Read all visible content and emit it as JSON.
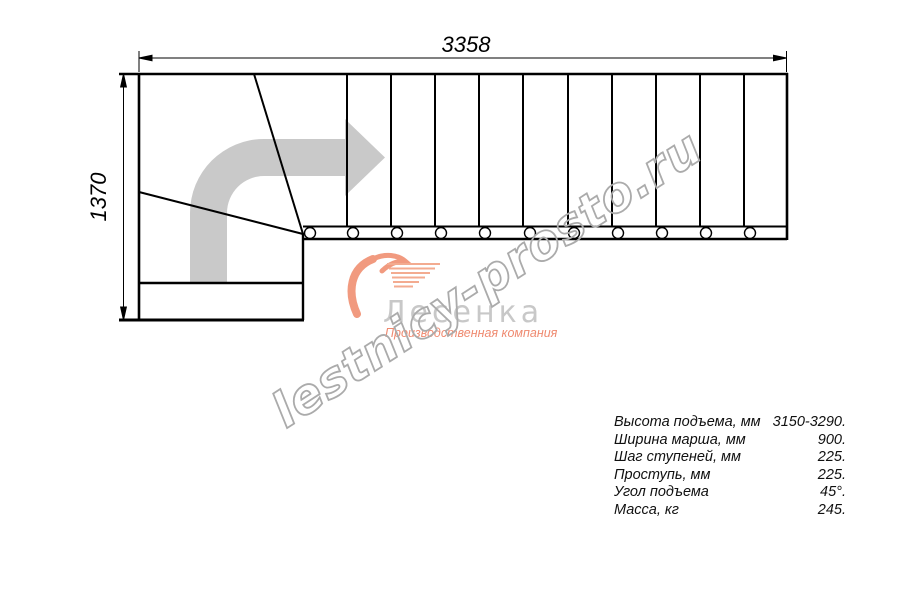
{
  "drawing": {
    "dim_width": "3358",
    "dim_height": "1370",
    "description": "staircase-plan-with-90-degree-turn"
  },
  "watermark": {
    "text": "lestnicy-prosto.ru"
  },
  "logo": {
    "name": "Лесенка",
    "tagline": "Производственная компания"
  },
  "specs": {
    "rows": [
      {
        "label": "Высота подъема, мм",
        "value": "3150-3290."
      },
      {
        "label": "Ширина марша, мм",
        "value": "900."
      },
      {
        "label": "Шаг ступеней, мм",
        "value": "225."
      },
      {
        "label": "Проступь, мм",
        "value": "225."
      },
      {
        "label": "Угол подъема",
        "value": "45°."
      },
      {
        "label": "Масса, кг",
        "value": "245."
      }
    ]
  },
  "colors": {
    "line": "#000000",
    "direction_arrow_gray": "#c9c9c9",
    "watermark_gray": "#ababab",
    "logo_gray": "#c8c8c8",
    "logo_salmon": "#ef8a70"
  }
}
